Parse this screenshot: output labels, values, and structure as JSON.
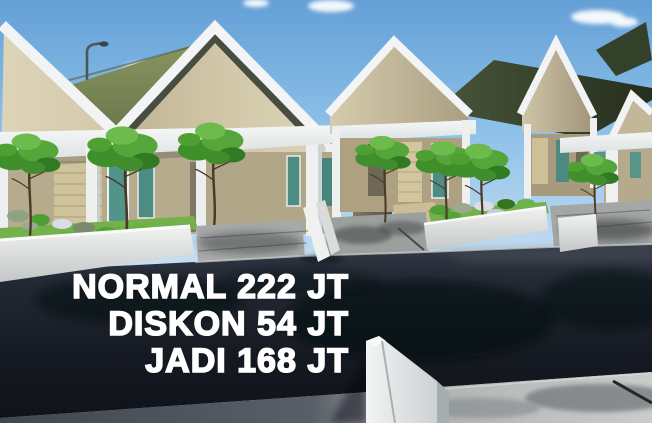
{
  "promo": {
    "line_normal": "NORMAL 222 JT",
    "line_diskon": "DISKON 54 JT",
    "line_jadi": "JADI 168 JT",
    "prices": {
      "normal_jt": 222,
      "diskon_jt": 54,
      "jadi_jt": 168
    },
    "text_color": "#ffffff"
  },
  "scene": {
    "type": "3d architectural render (real-estate promo image)",
    "subject": "Row of minimalist one-storey houses with white-trimmed gable facades, olive and dark-green roofs, teal doors and windows, khaki stone accent walls, landscaped planter yards with small trees, concrete driveways, a street lamp, a dark asphalt road and a sunlit sidewalk in the foreground",
    "house_count_visible": 5,
    "objects": [
      "sky",
      "cloud",
      "street-lamp",
      "gable-house",
      "olive-roof",
      "dark-green-roof",
      "white-trim",
      "teal-door",
      "teal-window",
      "stone-accent-wall",
      "canopy",
      "column",
      "planter-wall",
      "shrubs",
      "grass",
      "tree",
      "driveway",
      "divider-wall",
      "road",
      "tree-shadow",
      "sidewalk",
      "gate-wall"
    ],
    "palette": {
      "sky_blue": "#7db8e6",
      "cloud_white": "#f7fafc",
      "wall_beige": "#d6ccae",
      "trim_white": "#f1f3f4",
      "roof_olive": "#7b8756",
      "roof_dark_green": "#2f3a26",
      "door_window_teal": "#4f8d84",
      "stone_khaki": "#cfc39b",
      "grass_green": "#74b04c",
      "tree_green": "#4f9f33",
      "driveway_grey": "#a6a9a7",
      "road_asphalt": "#171b22",
      "sidewalk_grey": "#c6c9c7"
    }
  }
}
